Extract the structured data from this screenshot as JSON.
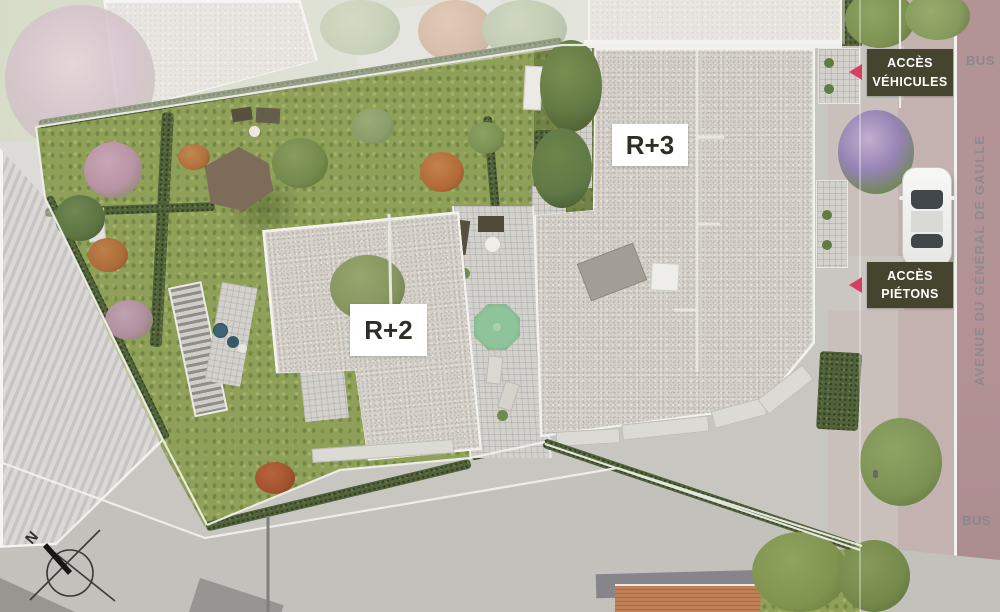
{
  "labels": {
    "building_r3": "R+3",
    "building_r2": "R+2",
    "access_vehicles_line1": "ACCÈS",
    "access_vehicles_line2": "VÉHICULES",
    "access_pedestrians_line1": "ACCÈS",
    "access_pedestrians_line2": "PIÉTONS"
  },
  "street": {
    "name": "AVENUE DU GÉNÉRAL DE GAULLE",
    "bus_top": "BUS",
    "bus_bottom": "BUS"
  },
  "compass": {
    "north": "N"
  },
  "colors": {
    "access_label_background": "#45452f",
    "access_label_text": "#ffffff",
    "access_arrow": "#d63e63",
    "building_label_background": "#ffffff",
    "building_label_text": "#2e2e26",
    "roof_gravel": "#d5d1ca",
    "grass": "#8fa058",
    "hedge": "#51613a",
    "road_avenue": "#b29295",
    "sidewalk": "#c9bfbb",
    "pavement": "#c8c6c1",
    "bus_text": "#8a878c",
    "street_name_text": "#8d8a90"
  }
}
